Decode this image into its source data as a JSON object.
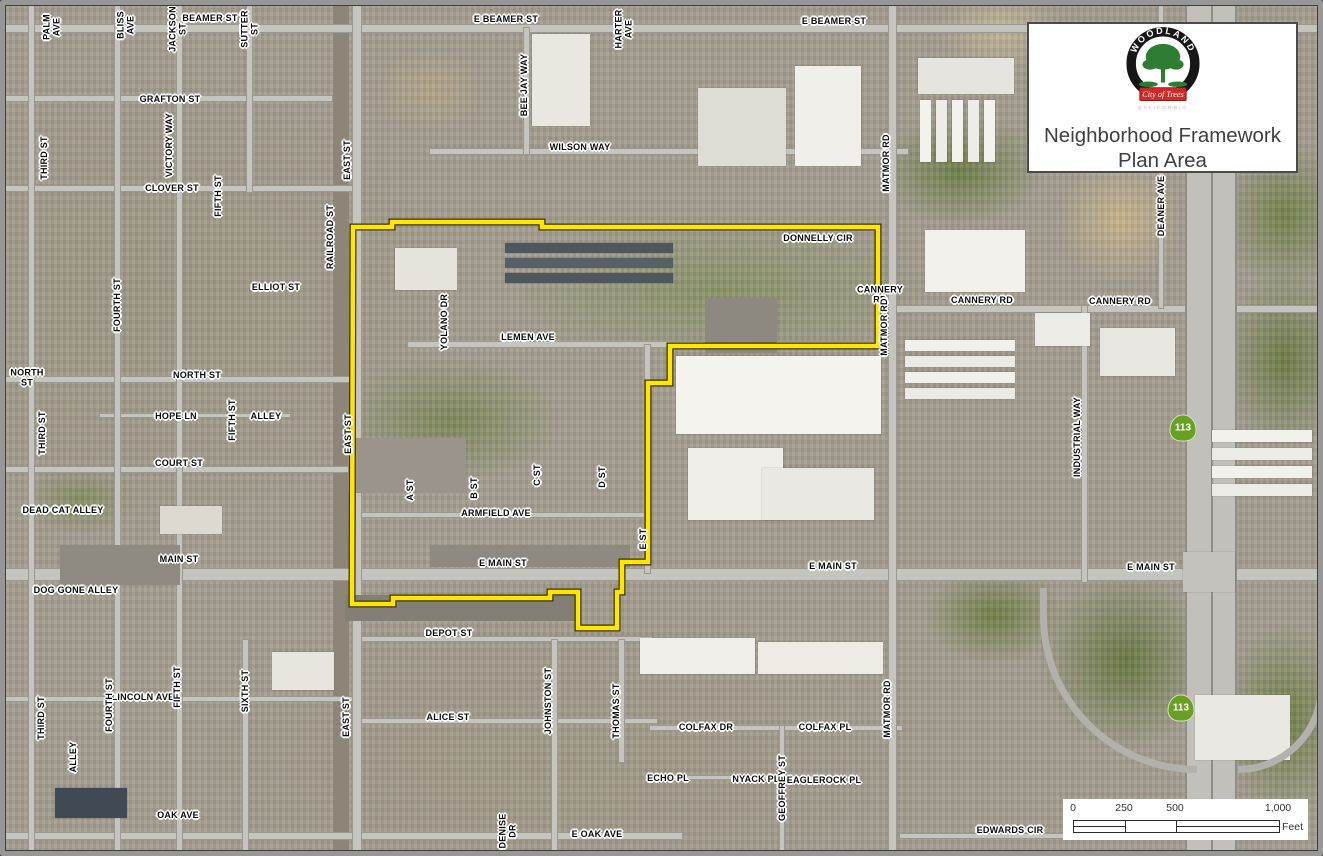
{
  "title_box": {
    "line1": "Neighborhood Framework",
    "line2": "Plan Area",
    "logo": {
      "top": "WOODLAND",
      "banner": "City of Trees",
      "bottom": "CALIFORNIA",
      "ring_color": "#161616",
      "tree_color": "#2e7d32",
      "banner_color": "#cf2a27"
    }
  },
  "scale_bar": {
    "ticks": [
      "0",
      "250",
      "500",
      "1,000"
    ],
    "unit": "Feet"
  },
  "map": {
    "boundary": {
      "color": "#FFE600",
      "casing_color": "#3a3200",
      "points": "353,227 392,227 392,222 542,222 542,227 878,227 878,346 670,346 670,383 648,383 648,562 622,562 622,592 617,592 617,628 578,628 578,592 550,592 550,598 393,598 393,604 352,604"
    },
    "shields": [
      {
        "label": "113",
        "x": 1183,
        "y": 428,
        "color": "#67a022"
      },
      {
        "label": "113",
        "x": 1181,
        "y": 708,
        "color": "#67a022"
      }
    ],
    "labels": [
      {
        "text": "PALM\nAVE",
        "x": 52,
        "y": 27,
        "o": "v"
      },
      {
        "text": "BLISS\nAVE",
        "x": 126,
        "y": 25,
        "o": "v"
      },
      {
        "text": "JACKSON\nST",
        "x": 178,
        "y": 29,
        "o": "v"
      },
      {
        "text": "BEAMER ST",
        "x": 210,
        "y": 19,
        "o": "h"
      },
      {
        "text": "SUTTER\nST",
        "x": 250,
        "y": 29,
        "o": "v"
      },
      {
        "text": "E BEAMER ST",
        "x": 506,
        "y": 20,
        "o": "h"
      },
      {
        "text": "HARTER\nAVE",
        "x": 624,
        "y": 29,
        "o": "v"
      },
      {
        "text": "BEE JAY WAY",
        "x": 525,
        "y": 85,
        "o": "v"
      },
      {
        "text": "WILSON WAY",
        "x": 580,
        "y": 148,
        "o": "h"
      },
      {
        "text": "E BEAMER ST",
        "x": 834,
        "y": 22,
        "o": "h"
      },
      {
        "text": "MATMOR RD",
        "x": 887,
        "y": 163,
        "o": "v"
      },
      {
        "text": "DEANER AVE",
        "x": 1162,
        "y": 206,
        "o": "v"
      },
      {
        "text": "THIRD ST",
        "x": 45,
        "y": 158,
        "o": "v"
      },
      {
        "text": "GRAFTON ST",
        "x": 170,
        "y": 100,
        "o": "h"
      },
      {
        "text": "VICTORY WAY",
        "x": 170,
        "y": 145,
        "o": "v"
      },
      {
        "text": "CLOVER ST",
        "x": 172,
        "y": 189,
        "o": "h"
      },
      {
        "text": "FIFTH ST",
        "x": 219,
        "y": 196,
        "o": "v"
      },
      {
        "text": "EAST ST",
        "x": 348,
        "y": 160,
        "o": "v"
      },
      {
        "text": "FOURTH ST",
        "x": 118,
        "y": 305,
        "o": "v"
      },
      {
        "text": "ELLIOT ST",
        "x": 276,
        "y": 288,
        "o": "h"
      },
      {
        "text": "RAILROAD ST",
        "x": 331,
        "y": 237,
        "o": "v"
      },
      {
        "text": "NORTH\nST",
        "x": 27,
        "y": 378,
        "o": "h"
      },
      {
        "text": "NORTH ST",
        "x": 197,
        "y": 376,
        "o": "h"
      },
      {
        "text": "THIRD ST",
        "x": 43,
        "y": 433,
        "o": "v"
      },
      {
        "text": "HOPE LN",
        "x": 176,
        "y": 417,
        "o": "h"
      },
      {
        "text": "FIFTH ST",
        "x": 233,
        "y": 420,
        "o": "v"
      },
      {
        "text": "ALLEY",
        "x": 266,
        "y": 417,
        "o": "h"
      },
      {
        "text": "EAST ST",
        "x": 349,
        "y": 434,
        "o": "v"
      },
      {
        "text": "COURT ST",
        "x": 179,
        "y": 464,
        "o": "h"
      },
      {
        "text": "DEAD CAT ALLEY",
        "x": 63,
        "y": 511,
        "o": "h"
      },
      {
        "text": "MAIN ST",
        "x": 179,
        "y": 560,
        "o": "h"
      },
      {
        "text": "DOG GONE ALLEY",
        "x": 76,
        "y": 591,
        "o": "h"
      },
      {
        "text": "DONNELLY CIR",
        "x": 818,
        "y": 239,
        "o": "h"
      },
      {
        "text": "CANNERY\nRD",
        "x": 880,
        "y": 295,
        "o": "h"
      },
      {
        "text": "CANNERY RD",
        "x": 982,
        "y": 301,
        "o": "h"
      },
      {
        "text": "CANNERY RD",
        "x": 1120,
        "y": 302,
        "o": "h"
      },
      {
        "text": "MATMOR RD",
        "x": 885,
        "y": 327,
        "o": "v"
      },
      {
        "text": "YOLANO DR",
        "x": 445,
        "y": 322,
        "o": "v"
      },
      {
        "text": "LEMEN AVE",
        "x": 528,
        "y": 338,
        "o": "h"
      },
      {
        "text": "A ST",
        "x": 411,
        "y": 490,
        "o": "v"
      },
      {
        "text": "B ST",
        "x": 475,
        "y": 488,
        "o": "v"
      },
      {
        "text": "C ST",
        "x": 538,
        "y": 475,
        "o": "v"
      },
      {
        "text": "D ST",
        "x": 603,
        "y": 477,
        "o": "v"
      },
      {
        "text": "ARMFIELD AVE",
        "x": 496,
        "y": 514,
        "o": "h"
      },
      {
        "text": "E ST",
        "x": 644,
        "y": 539,
        "o": "v"
      },
      {
        "text": "E MAIN ST",
        "x": 503,
        "y": 564,
        "o": "h"
      },
      {
        "text": "E MAIN ST",
        "x": 833,
        "y": 567,
        "o": "h"
      },
      {
        "text": "E MAIN ST",
        "x": 1151,
        "y": 568,
        "o": "h"
      },
      {
        "text": "INDUSTRIAL WAY",
        "x": 1078,
        "y": 437,
        "o": "v"
      },
      {
        "text": "DEPOT ST",
        "x": 449,
        "y": 634,
        "o": "h"
      },
      {
        "text": "ALICE ST",
        "x": 448,
        "y": 718,
        "o": "h"
      },
      {
        "text": "JOHNSTON ST",
        "x": 549,
        "y": 701,
        "o": "v"
      },
      {
        "text": "THOMAS ST",
        "x": 617,
        "y": 711,
        "o": "v"
      },
      {
        "text": "COLFAX DR",
        "x": 706,
        "y": 728,
        "o": "h"
      },
      {
        "text": "COLFAX PL",
        "x": 825,
        "y": 728,
        "o": "h"
      },
      {
        "text": "MATMOR RD",
        "x": 888,
        "y": 709,
        "o": "v"
      },
      {
        "text": "ECHO PL",
        "x": 668,
        "y": 779,
        "o": "h"
      },
      {
        "text": "NYACK PL",
        "x": 756,
        "y": 780,
        "o": "h"
      },
      {
        "text": "GEOFFREY ST",
        "x": 783,
        "y": 788,
        "o": "v"
      },
      {
        "text": "EAGLEROCK PL",
        "x": 824,
        "y": 781,
        "o": "h"
      },
      {
        "text": "DENISE\nDR",
        "x": 508,
        "y": 831,
        "o": "v"
      },
      {
        "text": "E OAK AVE",
        "x": 597,
        "y": 835,
        "o": "h"
      },
      {
        "text": "EDWARDS CIR",
        "x": 1010,
        "y": 831,
        "o": "h"
      },
      {
        "text": "LINCOLN AVE",
        "x": 143,
        "y": 698,
        "o": "h"
      },
      {
        "text": "FOURTH ST",
        "x": 110,
        "y": 705,
        "o": "v"
      },
      {
        "text": "THIRD ST",
        "x": 42,
        "y": 718,
        "o": "v"
      },
      {
        "text": "FIFTH ST",
        "x": 178,
        "y": 687,
        "o": "v"
      },
      {
        "text": "SIXTH ST",
        "x": 246,
        "y": 691,
        "o": "v"
      },
      {
        "text": "ALLEY",
        "x": 74,
        "y": 757,
        "o": "v"
      },
      {
        "text": "EAST ST",
        "x": 347,
        "y": 717,
        "o": "v"
      },
      {
        "text": "OAK AVE",
        "x": 178,
        "y": 816,
        "o": "h"
      }
    ]
  }
}
